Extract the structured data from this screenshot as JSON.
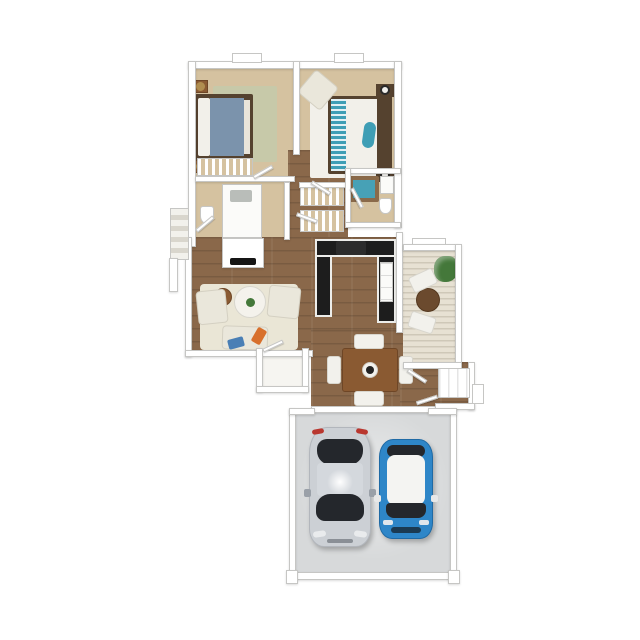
{
  "scene": {
    "type": "3D rendered apartment floor plan, top-down view, no text labels",
    "background": "#ffffff"
  },
  "palette": {
    "wall": "#ffffff",
    "wall_edge": "#c6c6c4",
    "carpet": "#d5c2a0",
    "wood": "#8a684a",
    "tile_patio": "#e7e1d3",
    "garage_floor": "#d7d9da",
    "bed1_duvet": "#7b93ac",
    "bed2_stripe": "#3f9eb5",
    "bed_frame": "#55422f",
    "rug_sage": "#c7c9a9",
    "rug_cream": "#eae6d6",
    "linen_white": "#f2f0ea",
    "counter_black": "#1d1d1d",
    "cabinet_white": "#fbfbf9",
    "table_brown": "#8a5a32",
    "tub_teal": "#47a1b6",
    "tub_frame": "#8a6a4a",
    "sink_gray": "#b9bdb9",
    "plant_green": "#44783a",
    "accent_orange": "#d8702c",
    "throw_blue": "#4a7fb5",
    "car_silver": "#ccd0d5",
    "car_blue": "#2e86c8",
    "car_glass": "#24272c",
    "car_roof_white": "#f4f4f2",
    "taillight_red": "#b9372f",
    "lamp_gold": "#b08d4f"
  },
  "rooms": [
    {
      "name": "bedroom-1",
      "floor": "carpet",
      "contents": [
        "double-bed-blue",
        "sage-rug",
        "two-nightstands",
        "gold-lamps",
        "closet-with-hanging-clothes"
      ]
    },
    {
      "name": "bedroom-2",
      "floor": "carpet",
      "contents": [
        "double-bed-teal-stripe",
        "white-rug",
        "two-nightstands",
        "lamps",
        "corner-armchair"
      ]
    },
    {
      "name": "bathroom-1",
      "floor": "carpet",
      "contents": [
        "vanity-sink",
        "toilet",
        "fireplace-facing-living-room"
      ]
    },
    {
      "name": "bathroom-2",
      "floor": "carpet",
      "contents": [
        "teal-tub",
        "toilet",
        "vanity"
      ]
    },
    {
      "name": "hallway",
      "floor": "wood",
      "contents": [
        "linen-closets",
        "open-doors"
      ]
    },
    {
      "name": "living-room",
      "floor": "wood",
      "contents": [
        "cream-rug",
        "two-armchairs",
        "chaise",
        "round-coffee-table",
        "plant",
        "side-table",
        "orange-pillow",
        "blue-throw"
      ]
    },
    {
      "name": "kitchen",
      "floor": "wood",
      "contents": [
        "u-shaped-black-counter",
        "stove",
        "appliance-stack"
      ]
    },
    {
      "name": "dining-area",
      "floor": "wood",
      "contents": [
        "square-table",
        "four-white-chairs",
        "centerpiece"
      ]
    },
    {
      "name": "patio",
      "floor": "plank-tile",
      "contents": [
        "potted-plant",
        "round-table",
        "two-chairs"
      ]
    },
    {
      "name": "entry",
      "floor": "wood",
      "contents": [
        "closet",
        "open-door",
        "exterior-step"
      ]
    },
    {
      "name": "garage",
      "floor": "concrete",
      "contents": [
        "silver-sedan",
        "blue-compact-car"
      ]
    }
  ],
  "exterior": [
    "left-side-steps",
    "two-top-windows",
    "patio-window-bump"
  ],
  "vehicles": [
    {
      "name": "silver-sedan",
      "body": "#ccd0d5",
      "facing": "down",
      "details": [
        "red-taillights",
        "dark-windows",
        "roof-glare"
      ]
    },
    {
      "name": "blue-compact-car",
      "body": "#2e86c8",
      "facing": "down",
      "details": [
        "white-roof-panel",
        "dark-windows",
        "white-mirrors"
      ]
    }
  ]
}
